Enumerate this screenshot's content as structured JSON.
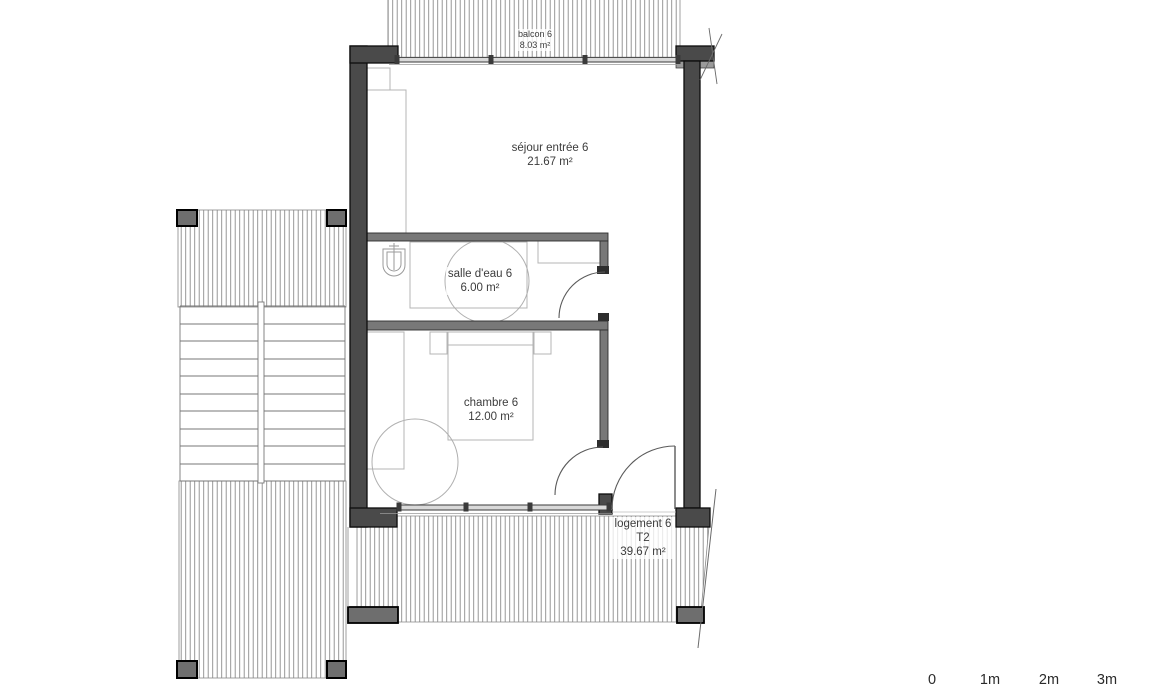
{
  "plan": {
    "rooms": {
      "balcon": {
        "name": "balcon 6",
        "area": "8.03 m²"
      },
      "sejour": {
        "name": "séjour entrée 6",
        "area": "21.67 m²"
      },
      "salle_eau": {
        "name": "salle d'eau 6",
        "area": "6.00 m²"
      },
      "chambre": {
        "name": "chambre 6",
        "area": "12.00 m²"
      }
    },
    "unit": {
      "name": "logement 6",
      "type": "T2",
      "area": "39.67 m²"
    },
    "scale_bar": {
      "labels": [
        "0",
        "1m",
        "2m",
        "3m"
      ]
    },
    "colors": {
      "wall_fill": "#4a4a4a",
      "partition_fill": "#787878",
      "hatch_line": "#8c8c8c",
      "window_fill": "#d9d9d9",
      "furniture_line": "#b4b4b4",
      "text": "#3c3c3c"
    }
  }
}
